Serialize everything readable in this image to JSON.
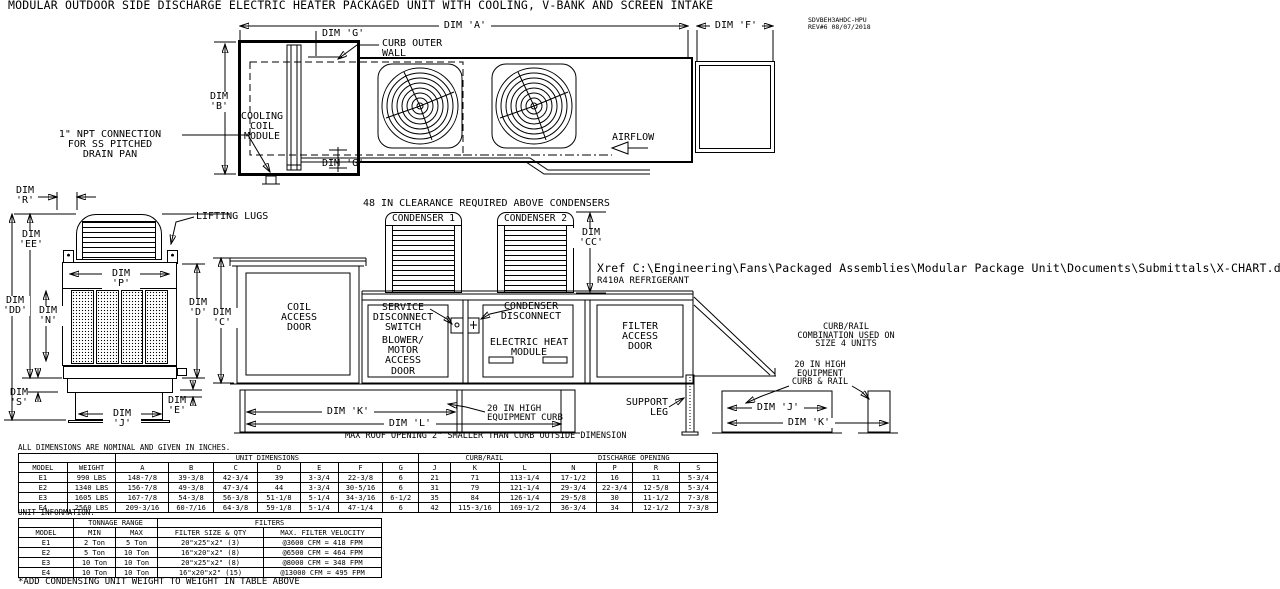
{
  "title": "MODULAR OUTDOOR SIDE DISCHARGE ELECTRIC HEATER PACKAGED UNIT WITH COOLING, V-BANK AND SCREEN INTAKE",
  "rev_block": {
    "drawing_number": "SDVBEH3AHDC-HPU",
    "revision": "REV#6   08/07/2018"
  },
  "plan_view": {
    "dim_a": "DIM 'A'",
    "dim_f": "DIM 'F'",
    "dim_b": "DIM\n'B'",
    "dim_g_top": "DIM 'G'",
    "dim_g_bottom": "DIM 'G'",
    "curb_outer_wall": "CURB OUTER\nWALL",
    "cooling_coil_module": "COOLING\nCOIL\nMODULE",
    "npt_note": "1\" NPT CONNECTION\nFOR SS PITCHED\nDRAIN PAN",
    "airflow": "AIRFLOW"
  },
  "end_view": {
    "lifting_lugs": "LIFTING LUGS",
    "dim_r": "DIM\n'R'",
    "dim_ee": "DIM\n'EE'",
    "dim_dd": "DIM\n'DD'",
    "dim_p": "DIM 'P'",
    "dim_n": "DIM\n'N'",
    "dim_s": "DIM\n'S'",
    "dim_j": "DIM 'J'",
    "dim_e": "DIM\n'E'",
    "dim_d": "DIM\n'D'",
    "dim_c": "DIM\n'C'"
  },
  "elevation": {
    "clearance_note": "48 IN CLEARANCE REQUIRED ABOVE CONDENSERS",
    "condenser1_label": "CONDENSER 1",
    "condenser2_label": "CONDENSER 2",
    "dim_cc": "DIM\n'CC'",
    "coil_access_door": "COIL\nACCESS\nDOOR",
    "service_disconnect": "SERVICE\nDISCONNECT\nSWITCH",
    "condenser_disconnect": "CONDENSER\nDISCONNECT",
    "blower_access_door": "BLOWER/\nMOTOR\nACCESS\nDOOR",
    "electric_heat_module": "ELECTRIC HEAT\nMODULE",
    "filter_access_door": "FILTER\nACCESS\nDOOR",
    "support_leg": "SUPPORT\nLEG",
    "equipment_curb_note": "20 IN HIGH\nEQUIPMENT CURB",
    "dim_k": "DIM 'K'",
    "dim_l": "DIM 'L'",
    "roof_opening_note": "MAX ROOF OPENING 2\" SMALLER THAN CURB OUTSIDE DIMENSION"
  },
  "curb_rail_detail": {
    "combination_note": "CURB/RAIL\nCOMBINATION USED ON\nSIZE 4 UNITS",
    "curb_rail_note": "20 IN HIGH\nEQUIPMENT\nCURB & RAIL",
    "dim_j": "DIM 'J'",
    "dim_k": "DIM 'K'"
  },
  "annotations": {
    "xref": "Xref C:\\Engineering\\Fans\\Packaged Assemblies\\Modular Package Unit\\Documents\\Submittals\\X-CHART.dwg",
    "refrigerant": "R410A REFRIGERANT"
  },
  "dim_table": {
    "note": "ALL DIMENSIONS ARE NOMINAL AND GIVEN IN INCHES.",
    "groups": [
      {
        "label": "",
        "span": 2
      },
      {
        "label": "UNIT DIMENSIONS",
        "span": 7
      },
      {
        "label": "CURB/RAIL",
        "span": 3
      },
      {
        "label": "DISCHARGE OPENING",
        "span": 4
      }
    ],
    "columns": [
      "MODEL",
      "WEIGHT",
      "A",
      "B",
      "C",
      "D",
      "E",
      "F",
      "G",
      "J",
      "K",
      "L",
      "N",
      "P",
      "R",
      "S"
    ],
    "rows": [
      [
        "E1",
        "990 LBS",
        "148-7/8",
        "39-3/8",
        "42-3/4",
        "39",
        "3-3/4",
        "22-3/8",
        "6",
        "21",
        "71",
        "113-1/4",
        "17-1/2",
        "16",
        "11",
        "5-3/4"
      ],
      [
        "E2",
        "1340 LBS",
        "156-7/8",
        "49-3/8",
        "47-3/4",
        "44",
        "3-3/4",
        "30-5/16",
        "6",
        "31",
        "79",
        "121-1/4",
        "29-3/4",
        "22-3/4",
        "12-5/8",
        "5-3/4"
      ],
      [
        "E3",
        "1605 LBS",
        "167-7/8",
        "54-3/8",
        "56-3/8",
        "51-1/8",
        "5-1/4",
        "34-3/16",
        "6-1/2",
        "35",
        "84",
        "126-1/4",
        "29-5/8",
        "30",
        "11-1/2",
        "7-3/8"
      ],
      [
        "E4",
        "2560 LBS",
        "209-3/16",
        "60-7/16",
        "64-3/8",
        "59-1/8",
        "5-1/4",
        "47-1/4",
        "6",
        "42",
        "115-3/16",
        "169-1/2",
        "36-3/4",
        "34",
        "12-1/2",
        "7-3/8"
      ]
    ]
  },
  "info_table": {
    "note": "UNIT INFORMATION.",
    "groups": [
      {
        "label": "",
        "span": 1
      },
      {
        "label": "TONNAGE RANGE",
        "span": 2
      },
      {
        "label": "FILTERS",
        "span": 2
      }
    ],
    "columns": [
      "MODEL",
      "MIN",
      "MAX",
      "FILTER SIZE & QTY",
      "MAX. FILTER VELOCITY"
    ],
    "rows": [
      [
        "E1",
        "2 Ton",
        "5 Ton",
        "20\"x25\"x2\" (3)",
        "@3600 CFM = 418 FPM"
      ],
      [
        "E2",
        "5 Ton",
        "10 Ton",
        "16\"x20\"x2\" (8)",
        "@6500 CFM = 464 FPM"
      ],
      [
        "E3",
        "10 Ton",
        "10 Ton",
        "20\"x25\"x2\" (8)",
        "@8000 CFM = 348 FPM"
      ],
      [
        "E4",
        "10 Ton",
        "10 Ton",
        "16\"x20\"x2\" (15)",
        "@13000 CFM = 495 FPM"
      ]
    ],
    "footnote": "*ADD CONDENSING UNIT WEIGHT TO WEIGHT IN TABLE ABOVE"
  }
}
